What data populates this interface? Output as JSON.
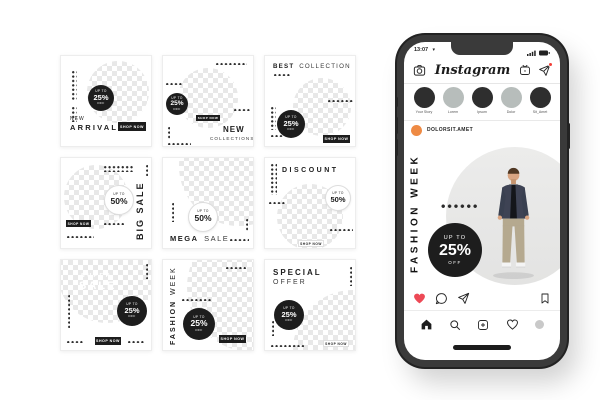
{
  "shop_now": "SHOP NOW",
  "badges": {
    "b25": {
      "top": "UP TO",
      "value": "25%",
      "bottom": "OFF"
    },
    "b50": {
      "top": "UP TO",
      "value": "50%"
    }
  },
  "templates": {
    "new_arrival": {
      "title_top": "NEW",
      "title_main": "ARRIVAL"
    },
    "new_collections": {
      "title_main": "NEW",
      "title_sub": "COLLECTIONS"
    },
    "best_collection": {
      "title_bold": "BEST",
      "title_light": "COLLECTION"
    },
    "big_sale": {
      "title": "BIG SALE"
    },
    "mega_sale": {
      "title_bold": "MEGA",
      "title_light": "SALE"
    },
    "discount": {
      "title": "DISCOUNT"
    },
    "super_sale": {
      "overlay_top": "SUPER",
      "overlay_main": "SALE"
    },
    "fashion_week": {
      "title_bold": "FASHION",
      "title_light": "WEEK"
    },
    "special_offer": {
      "title_bold": "SPECIAL",
      "title_light": "OFFER"
    }
  },
  "phone": {
    "status_time": "13:07",
    "app_logo": "Instagram",
    "stories": [
      {
        "label": "Your Story"
      },
      {
        "label": "Lorem"
      },
      {
        "label": "Ipsum"
      },
      {
        "label": "Dolor"
      },
      {
        "label": "Sit_Amet"
      }
    ],
    "post": {
      "username": "DOLORSIT.AMET",
      "vertical_title": "FASHION WEEK",
      "badge": {
        "top": "UP TO",
        "value": "25%",
        "bottom": "OFF"
      }
    }
  },
  "icons": {
    "caret_down": "▾"
  },
  "colors": {
    "accent-orange": "#EE8A44",
    "heart-red": "#ED4956",
    "notification-red": "#F23E36",
    "ink": "#1D1D1D",
    "story-dark": "#2E2E2E",
    "story-gray": "#B7BDBB",
    "arch-gray": "#E3E3E2",
    "phone-frame": "#3A3A3A"
  }
}
